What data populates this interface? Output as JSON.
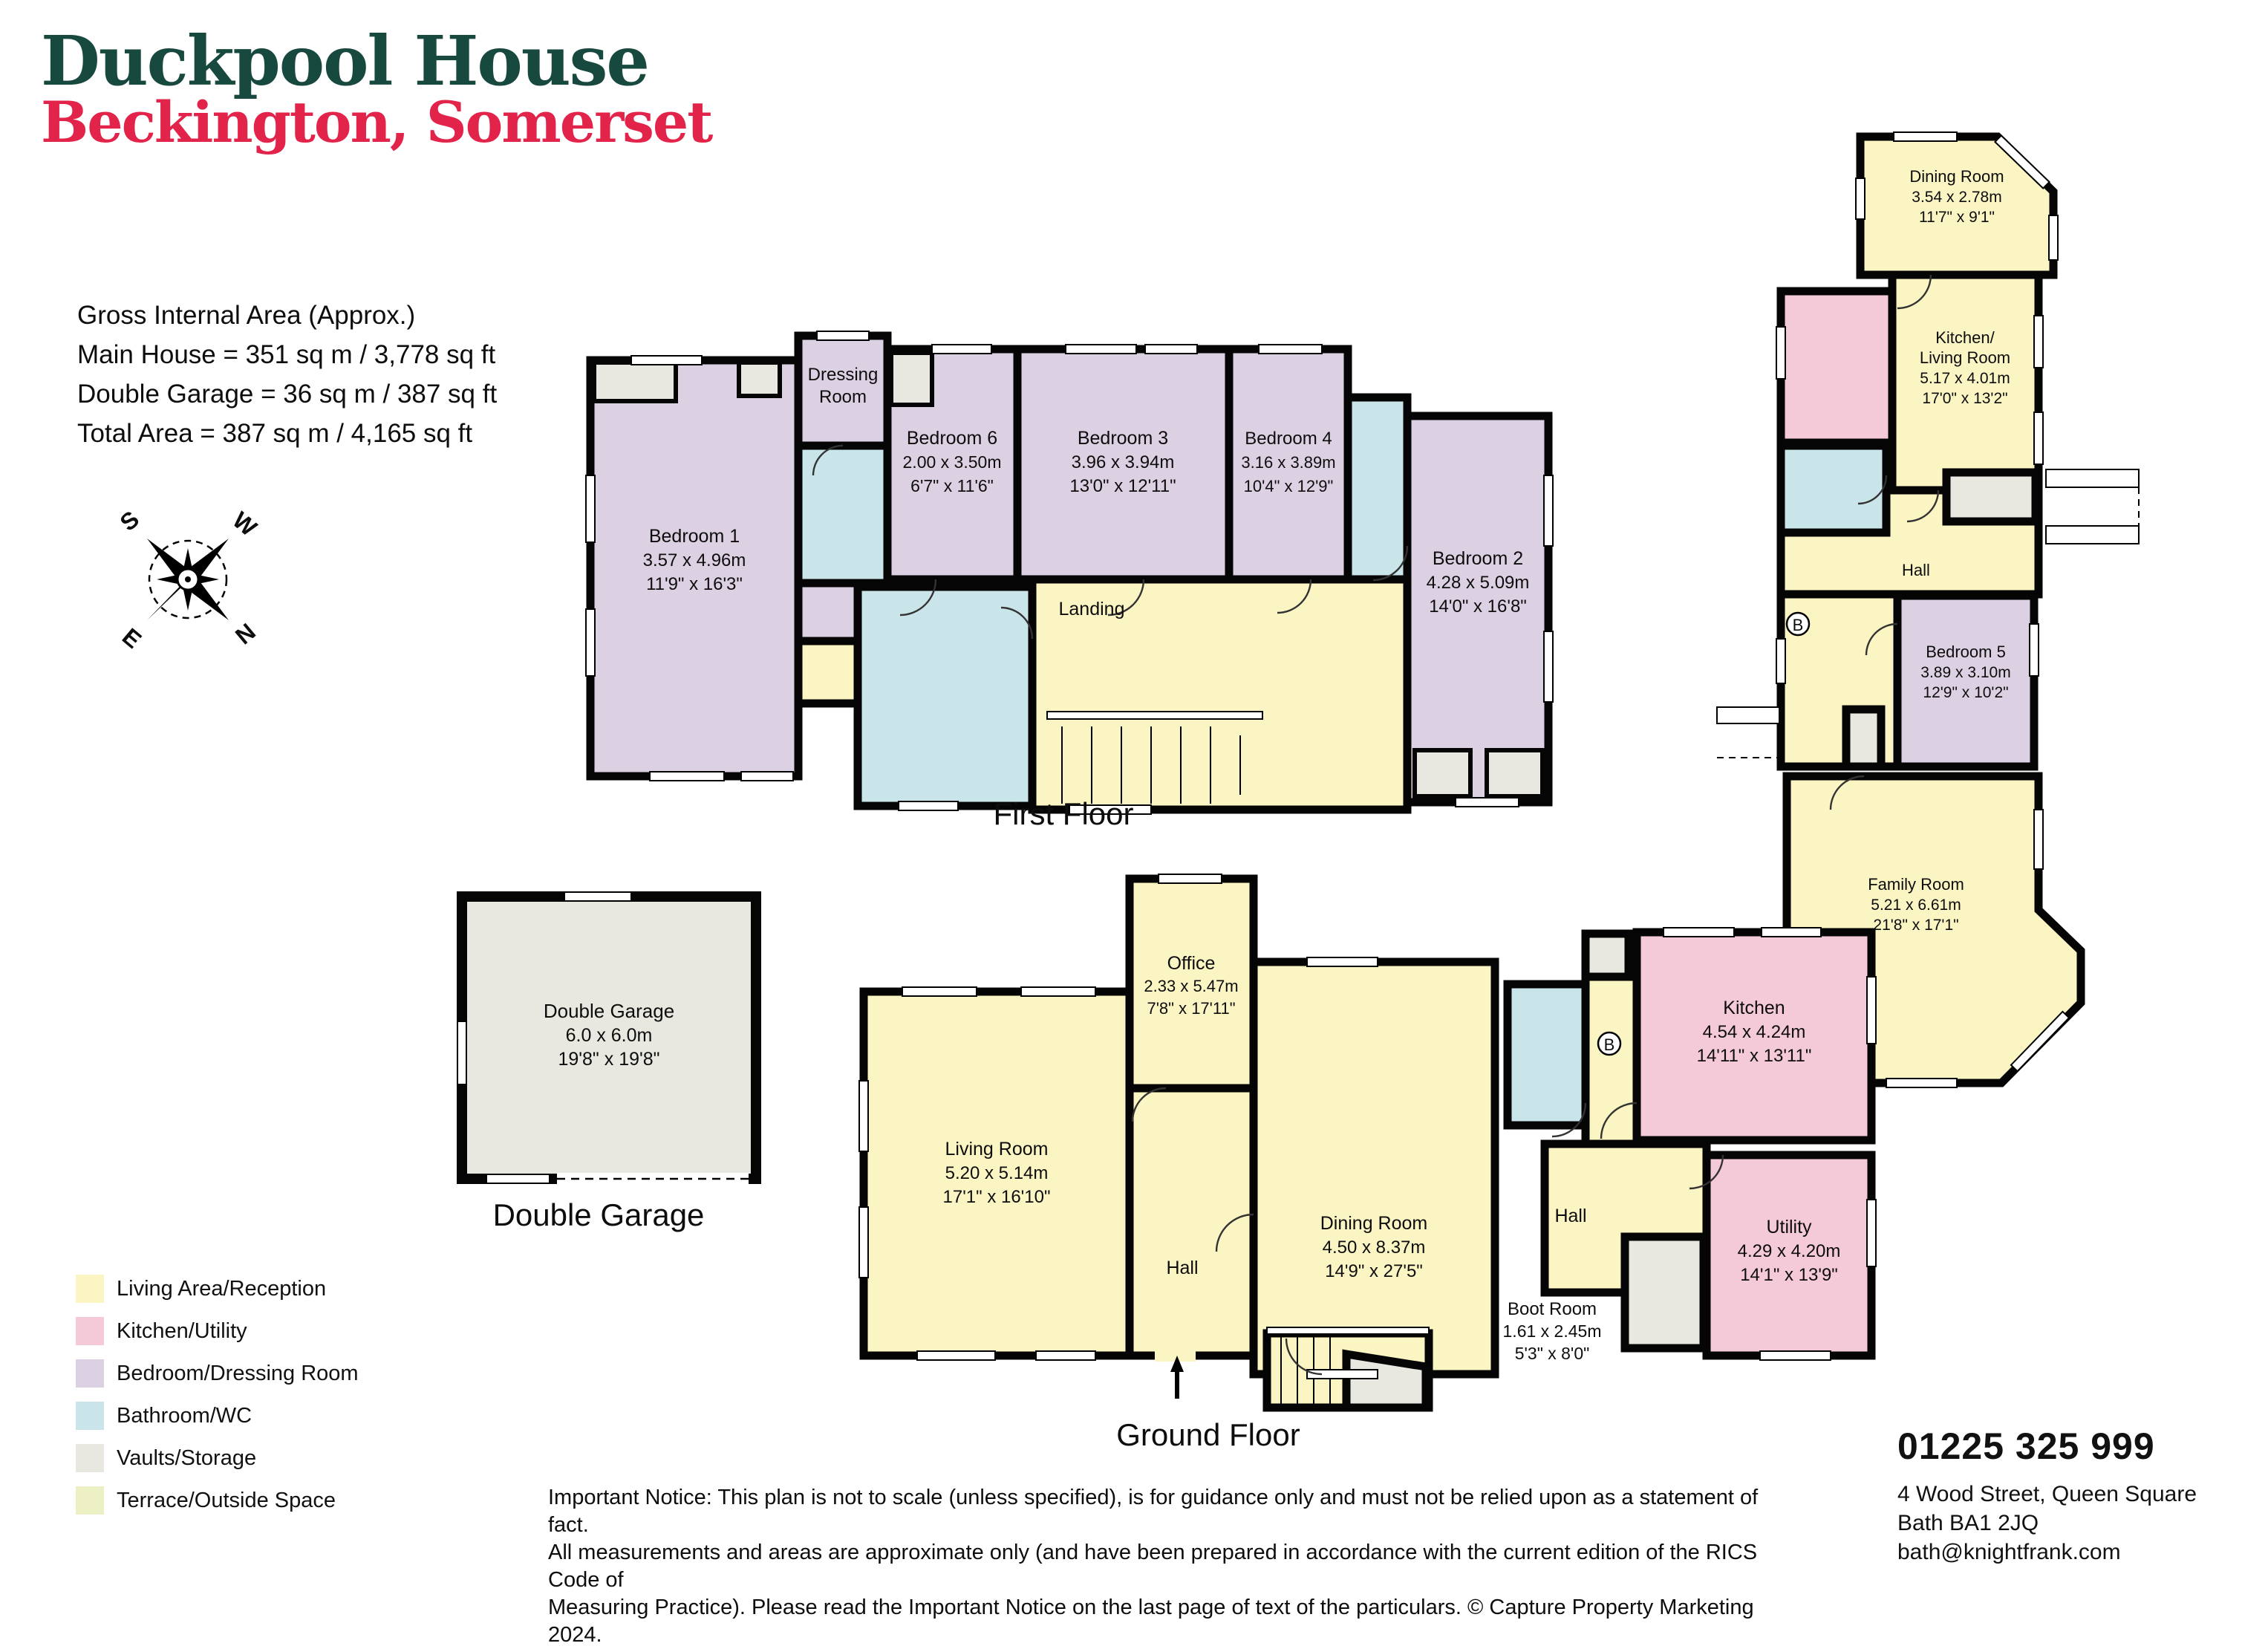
{
  "header": {
    "title": "Duckpool House",
    "subtitle": "Beckington, Somerset"
  },
  "area_summary": {
    "heading": "Gross Internal Area (Approx.)",
    "main_house": "Main House = 351 sq m / 3,778 sq ft",
    "double_garage": "Double Garage = 36 sq m / 387 sq ft",
    "total": "Total Area = 387 sq m /  4,165 sq ft"
  },
  "compass": {
    "n": "N",
    "e": "E",
    "s": "S",
    "w": "W"
  },
  "plans": {
    "first": {
      "caption": "First Floor",
      "rooms": {
        "bed1": {
          "name": "Bedroom 1",
          "m": "3.57 x 4.96m",
          "ft": "11'9\" x 16'3\""
        },
        "dressing": {
          "line1": "Dressing",
          "line2": "Room"
        },
        "bed6": {
          "name": "Bedroom 6",
          "m": "2.00 x 3.50m",
          "ft": "6'7\" x 11'6\""
        },
        "bed3": {
          "name": "Bedroom 3",
          "m": "3.96 x 3.94m",
          "ft": "13'0\" x 12'11\""
        },
        "bed4": {
          "name": "Bedroom 4",
          "m": "3.16 x 3.89m",
          "ft": "10'4\" x 12'9\""
        },
        "bed2": {
          "name": "Bedroom 2",
          "m": "4.28 x 5.09m",
          "ft": "14'0\" x 16'8\""
        },
        "landing": {
          "name": "Landing"
        }
      }
    },
    "ground": {
      "caption": "Ground Floor",
      "rooms": {
        "living": {
          "name": "Living Room",
          "m": "5.20 x 5.14m",
          "ft": "17'1\" x 16'10\""
        },
        "office": {
          "name": "Office",
          "m": "2.33 x 5.47m",
          "ft": "7'8\" x 17'11\""
        },
        "dining": {
          "name": "Dining Room",
          "m": "4.50 x 8.37m",
          "ft": "14'9\" x 27'5\""
        },
        "kitchen": {
          "name": "Kitchen",
          "m": "4.54 x 4.24m",
          "ft": "14'11\" x 13'11\""
        },
        "utility": {
          "name": "Utility",
          "m": "4.29 x 4.20m",
          "ft": "14'1\" x 13'9\""
        },
        "boot": {
          "name": "Boot Room",
          "m": "1.61 x 2.45m",
          "ft": "5'3\" x 8'0\""
        },
        "hall_left": {
          "name": "Hall"
        },
        "hall_right": {
          "name": "Hall"
        },
        "boiler": "B"
      }
    },
    "wing": {
      "rooms": {
        "dining": {
          "name": "Dining Room",
          "m": "3.54 x 2.78m",
          "ft": "11'7\" x 9'1\""
        },
        "kitchen_living": {
          "line1": "Kitchen/",
          "line2": "Living Room",
          "m": "5.17 x 4.01m",
          "ft": "17'0\" x 13'2\""
        },
        "hall": {
          "name": "Hall"
        },
        "bed5": {
          "name": "Bedroom 5",
          "m": "3.89 x 3.10m",
          "ft": "12'9\" x 10'2\""
        },
        "family": {
          "name": "Family Room",
          "m": "5.21 x 6.61m",
          "ft": "21'8\" x 17'1\""
        },
        "boiler": "B"
      }
    },
    "garage": {
      "caption": "Double Garage",
      "room": {
        "name": "Double Garage",
        "m": "6.0 x 6.0m",
        "ft": "19'8\" x 19'8\""
      }
    }
  },
  "legend": {
    "items": [
      {
        "label": "Living Area/Reception",
        "color": "#FBF4C3"
      },
      {
        "label": "Kitchen/Utility",
        "color": "#F4C9D8"
      },
      {
        "label": "Bedroom/Dressing Room",
        "color": "#DCD1E2"
      },
      {
        "label": "Bathroom/WC",
        "color": "#C9E5E9"
      },
      {
        "label": "Vaults/Storage",
        "color": "#E8E8E0"
      },
      {
        "label": "Terrace/Outside Space",
        "color": "#EDF0C5"
      }
    ]
  },
  "notice": {
    "line1": "Important Notice: This plan is not to scale (unless specified), is for guidance only and must not be relied upon as a statement of fact.",
    "line2": "All measurements and areas are approximate only (and have been prepared in accordance with the current edition of the RICS Code of",
    "line3": "Measuring Practice). Please read the Important Notice on the last page of text of the particulars. © Capture Property Marketing 2024."
  },
  "contact": {
    "phone": "01225 325 999",
    "address1": "4 Wood Street, Queen Square",
    "address2": "Bath BA1 2JQ",
    "email": "bath@knightfrank.com"
  }
}
